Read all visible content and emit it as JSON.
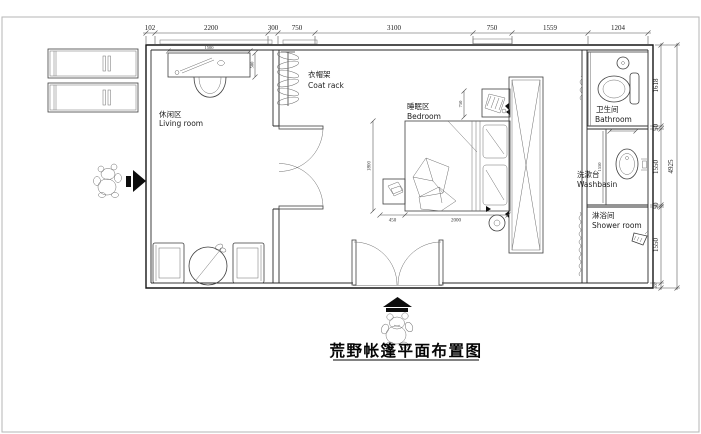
{
  "title": "荒野帐篷平面布置图",
  "top_dimensions": [
    "102",
    "2200",
    "300",
    "750",
    "3100",
    "750",
    "1559",
    "1204"
  ],
  "right_dimensions": [
    "1618",
    "50",
    "1550",
    "50",
    "1550",
    "107"
  ],
  "right_total_dimension": "4925",
  "interior_dimensions": {
    "desk_width": "1500",
    "desk_depth": "500",
    "bed_length": "1800",
    "nightstand_width": "450",
    "bed_width": "2000",
    "headboard_gap": "750",
    "basin_counter": "1550"
  },
  "rooms": {
    "living": {
      "zh": "休闲区",
      "en": "Living room"
    },
    "coat": {
      "zh": "衣帽架",
      "en": "Coat rack"
    },
    "bedroom": {
      "zh": "睡眠区",
      "en": "Bedroom"
    },
    "bathroom": {
      "zh": "卫生间",
      "en": "Bathroom"
    },
    "washbasin": {
      "zh": "洗漱台",
      "en": "Washbasin"
    },
    "shower": {
      "zh": "淋浴间",
      "en": "Shower room"
    }
  },
  "colors": {
    "wall": "#161616",
    "line": "#3f3f3f",
    "text": "#111111",
    "frame": "#b5b5b5"
  }
}
